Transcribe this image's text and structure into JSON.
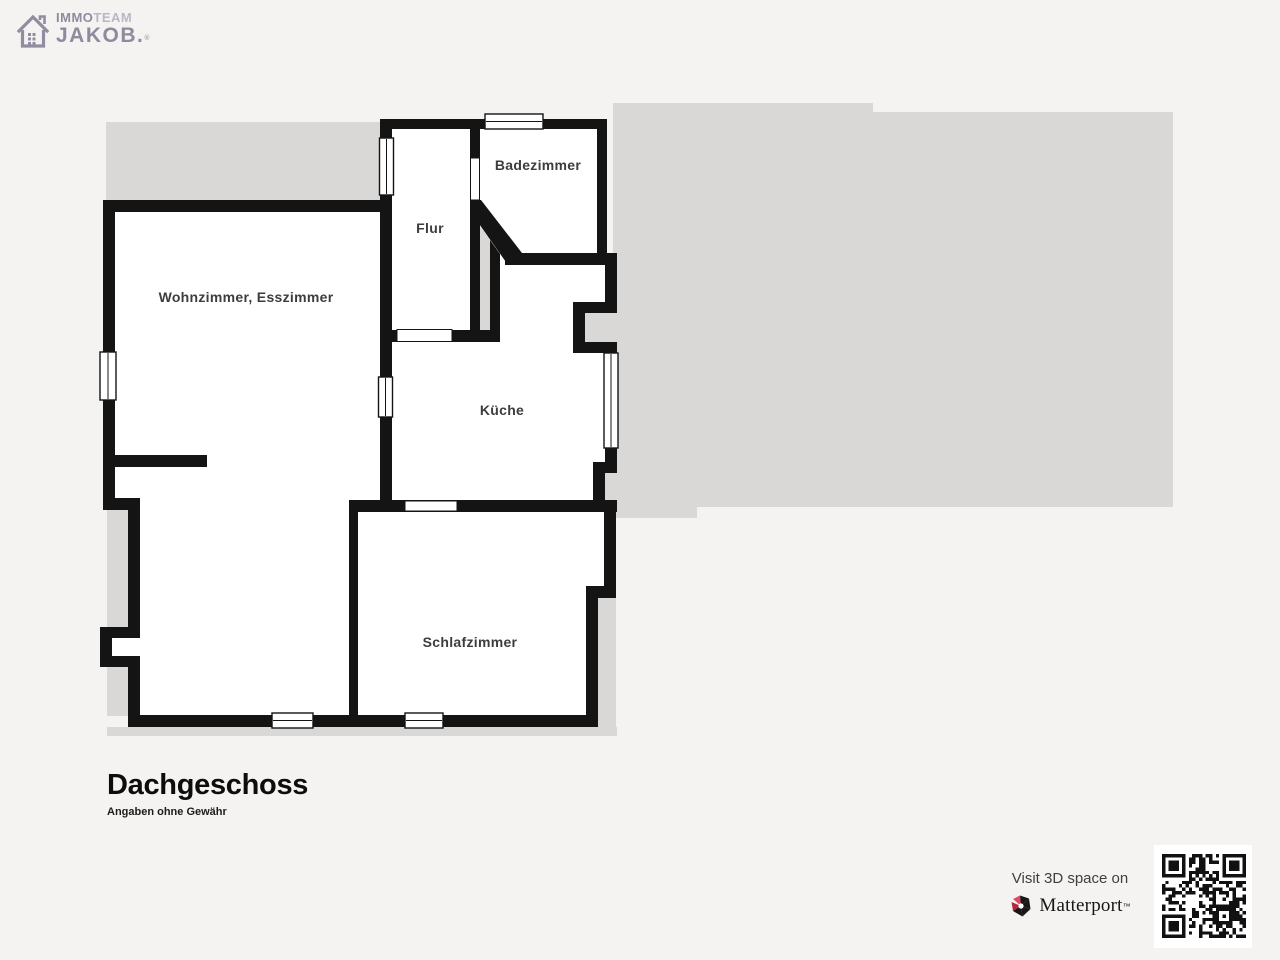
{
  "logo": {
    "brand_top_left": "IMMO",
    "brand_top_right": "TEAM",
    "brand_bottom": "JAKOB.",
    "registered_mark": "®"
  },
  "floorplan": {
    "rooms": [
      {
        "label": "Wohnzimmer, Esszimmer"
      },
      {
        "label": "Flur"
      },
      {
        "label": "Badezimmer"
      },
      {
        "label": "Küche"
      },
      {
        "label": "Schlafzimmer"
      }
    ]
  },
  "footer": {
    "title": "Dachgeschoss",
    "disclaimer": "Angaben ohne Gewähr"
  },
  "matterport": {
    "visit_text": "Visit 3D space on",
    "brand": "Matterport",
    "trademark": "™"
  },
  "colors": {
    "wall": "#141414",
    "room_fill": "#ffffff",
    "outside_gray": "#d9d8d6",
    "background": "#f4f3f1",
    "label_text": "#3d3d3d",
    "matterport_red": "#e5485f",
    "matterport_dark_red": "#b2293e"
  }
}
